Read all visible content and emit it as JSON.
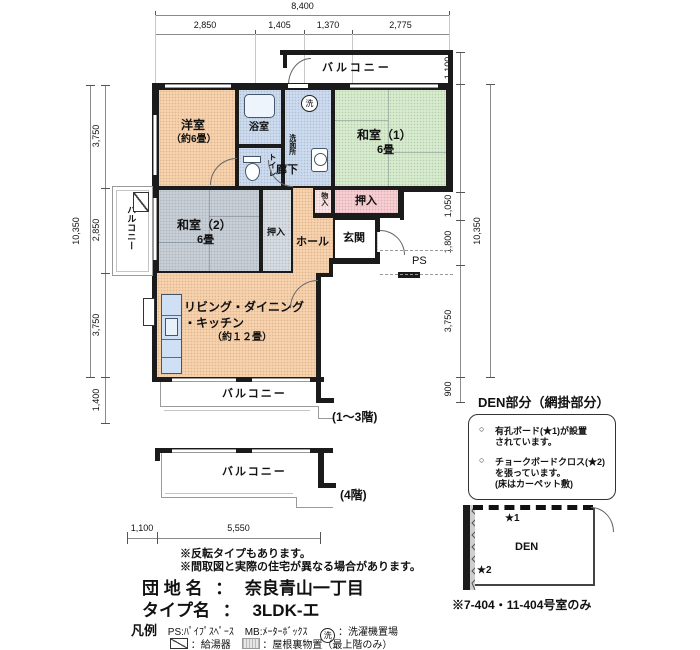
{
  "dimensions": {
    "top": {
      "total": "8,400",
      "seg": [
        "2,850",
        "1,405",
        "1,370",
        "2,775"
      ]
    },
    "left": {
      "total": "10,350",
      "seg": [
        "3,750",
        "2,850",
        "3,750",
        "1,400"
      ]
    },
    "right": {
      "total": "10,350",
      "seg": [
        "1,100",
        "3,750",
        "1,050",
        "1,800",
        "3,750",
        "900"
      ]
    },
    "bottom": {
      "seg": [
        "1,100",
        "5,550"
      ]
    }
  },
  "plan": {
    "rooms": {
      "yoshitsu": {
        "name": "洋室",
        "size": "（約6畳）"
      },
      "washitsu1": {
        "name": "和室（1）",
        "size": "6畳"
      },
      "washitsu2": {
        "name": "和室（2）",
        "size": "6畳"
      },
      "ldk": {
        "line1": "リビング・ダイニング",
        "line2": "・キッチン",
        "size": "（約１２畳）"
      },
      "bath": "浴室",
      "toilet": "トイレ",
      "washroom": "洗面所",
      "laundry_mark": "洗",
      "hallway": "廊下",
      "hall": "ホール",
      "entrance": "玄関",
      "oshiire_upper": "押入",
      "oshiire_washitsu2": "押入",
      "monoire": "物入",
      "ps": "PS"
    },
    "balconies": {
      "top": "バルコニー",
      "left": "バルコニー",
      "lower": "バルコニー",
      "lower4": "バルコニー"
    },
    "floor_notes": {
      "floors13": "(1〜3階)",
      "floor4": "(4階)"
    }
  },
  "den": {
    "title": "DEN部分（網掛部分）",
    "marker": "○",
    "bullet1a": "有孔ボード(★1)が設置",
    "bullet1b": "されています。",
    "bullet2a": "チョークボードクロス(★2)",
    "bullet2b": "を張っています。",
    "bullet2c": "(床はカーペット敷)",
    "star1": "★1",
    "star2": "★2",
    "label": "DEN",
    "note": "※7-404・11-404号室のみ"
  },
  "notes": {
    "n1": "※反転タイプもあります。",
    "n2": "※間取図と実際の住宅が異なる場合があります。"
  },
  "info": {
    "estate_label": "団 地 名",
    "estate_colon": "：",
    "estate_value": "奈良青山一丁目",
    "type_label": "タイプ名",
    "type_colon": "：",
    "type_value": "3LDK-エ"
  },
  "legend": {
    "title": "凡例",
    "ps": "PS:ﾊﾟｲﾌﾟｽﾍﾟｰｽ",
    "mb": "MB:ﾒｰﾀｰﾎﾞｯｸｽ",
    "laundry_symbol": "洗",
    "laundry": "：洗濯機置場",
    "heater": "：給湯器",
    "attic": "：屋根裏物置（最上階のみ）"
  }
}
